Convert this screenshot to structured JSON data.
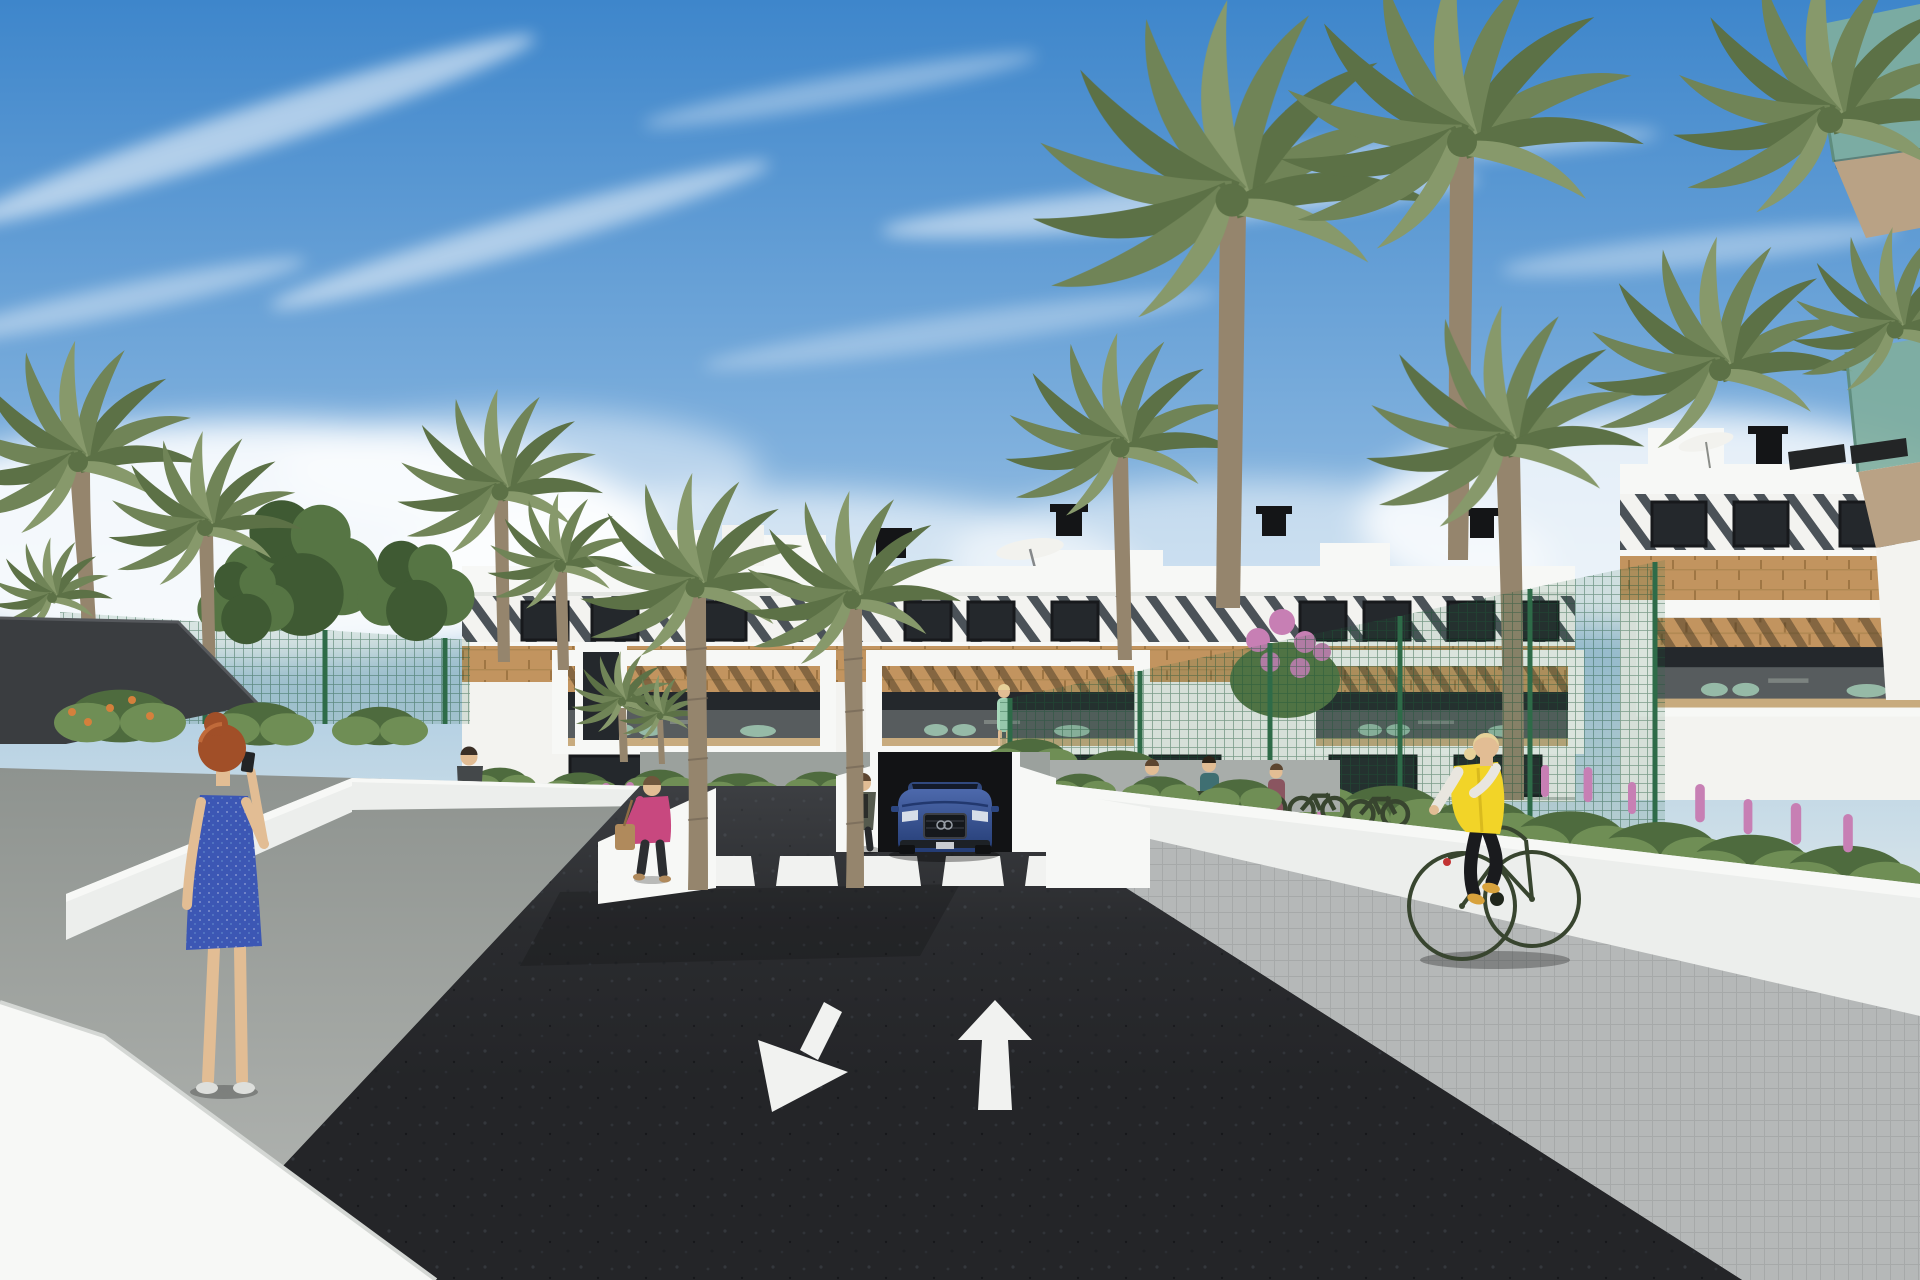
{
  "meta": {
    "title": "Architectural rendering — residential street view",
    "width": 1920,
    "height": 1280,
    "description": "3D architectural rendering of a modern white apartment complex: a palm-lined entrance road of dark asphalt with a zebra crosswalk and two painted lane arrows (one toward the viewer, one away), a blue SUV exiting an underground garage ramp, pedestrians on light walkways between white retaining walls, a cyclist in a yellow vest on the right sidewalk, lush gardens with pink and orange flowers, green mesh fences and a dark shade sail, all under a blue sky with wispy diagonal clouds and horizon haze."
  },
  "colors": {
    "sky_top": "#3e86cb",
    "sky_mid": "#7fb0dd",
    "sky_low": "#b9d3e4",
    "sky_horizon": "#d9e5ea",
    "cloud": "#ffffff",
    "building_white": "#f3f3f0",
    "wall_bright": "#f7f8f6",
    "wall_white": "#eceeec",
    "parapet_line": "#e4e6e2",
    "slat_dark": "#4b5258",
    "window_dark": "#24282c",
    "window_frame": "#17191c",
    "wood": "#c2945f",
    "wood_seam": "#9f7644",
    "glass_rail": "#cdd8d5",
    "road": "#242528",
    "road_mark": "#f1f2f0",
    "sidewalk_left_dark": "#8e938f",
    "sidewalk_left_light": "#b5b8b5",
    "sidewalk_right": "#b5b8b8",
    "paver_line": "#a6a9a9",
    "canopy": "#3a3d40",
    "fence": "#2e6b48",
    "palm_a": "#708457",
    "palm_b": "#5c7146",
    "palm_c": "#87996b",
    "trunk": "#95856d",
    "trunk_dark": "#6f6354",
    "tree_green": "#3f5a33",
    "tree_green2": "#567544",
    "bush": "#4e6b3e",
    "bush2": "#6f8e55",
    "flower_pink": "#c77fb4",
    "flower_orange": "#d4803c",
    "car_blue": "#4d69ac",
    "car_blue_dark": "#243c74",
    "chimney": "#141517",
    "umbrella": "#f2f2ee",
    "garage_dark": "#121315",
    "balcony_glass_teal": "#7fae9e",
    "soffit_tan": "#b9a285",
    "awning_dark": "#232526",
    "skin": "#e2bd94",
    "hair_red": "#a14f28",
    "hair_blonde": "#e6d199",
    "hair_dark": "#5d4630",
    "dress_blue": "#3c57b4",
    "jacket_pink": "#c8487f",
    "bag_tan": "#b08a5c",
    "vest_yellow": "#f2d428",
    "sleeve_white": "#e9e6df",
    "pants_dark": "#1a1b1e",
    "bike_olive": "#38452f",
    "shoe_yellow": "#d8a23c",
    "dress_seafoam": "#a8d8bc",
    "shadow": "#000000"
  },
  "road": {
    "surface": "dark asphalt",
    "crosswalk_stripe_count": 6,
    "lane_arrows": [
      {
        "direction": "toward-viewer-down-left"
      },
      {
        "direction": "away-from-viewer-up"
      }
    ]
  },
  "vehicles": [
    {
      "type": "suv",
      "color_name": "blue",
      "location": "exiting underground garage ramp beneath the central building"
    }
  ],
  "people": [
    {
      "id": "woman-blue-dress",
      "pose": "standing, phone to ear",
      "hair": "red",
      "clothing": "blue patterned knee-length dress",
      "location": "left walkway foreground"
    },
    {
      "id": "man-walking",
      "clothing": "dark shirt, gray trousers",
      "location": "left path behind low wall"
    },
    {
      "id": "woman-pink-jacket",
      "clothing": "pink jacket, dark trousers, tan handbag",
      "location": "left path near crosswalk"
    },
    {
      "id": "woman-at-crosswalk",
      "clothing": "olive cardigan, dark top",
      "location": "left end of crosswalk"
    },
    {
      "id": "pedestrian-group",
      "count": 3,
      "location": "building forecourt right of the garage, behind white wall"
    },
    {
      "id": "woman-on-balcony",
      "clothing": "seafoam green dress",
      "location": "first-floor balcony of central building"
    },
    {
      "id": "cyclist",
      "clothing": "yellow vest, white sleeves, black leggings",
      "hair": "blonde",
      "bike_color": "olive green",
      "location": "right sidewalk riding away"
    }
  ],
  "buildings": {
    "central": {
      "floors": 3,
      "style": "white render, diagonal louvre attic band, timber-clad spandrel, three framed balconies with timber pergolas and glass rails",
      "roof_items": [
        "stair boxes",
        "black chimneys",
        "white parasol"
      ]
    },
    "right_wing": {
      "style": "same facade seen closer, behind green mesh fence with flowering shrubs"
    },
    "foreground_right": {
      "style": "corner of nearer block with green-glass balconies, tan soffits and dark awnings"
    }
  },
  "landscape": {
    "palm_count_large": 10,
    "deciduous_trees": 3,
    "features": [
      "dark shade sail",
      "green mesh fences",
      "pink flower spikes",
      "orange flowers",
      "lilac shrub",
      "parked bicycles"
    ]
  },
  "sky": {
    "condition": "sunny, wispy diagonal clouds upper-left, bright haze at horizon"
  }
}
